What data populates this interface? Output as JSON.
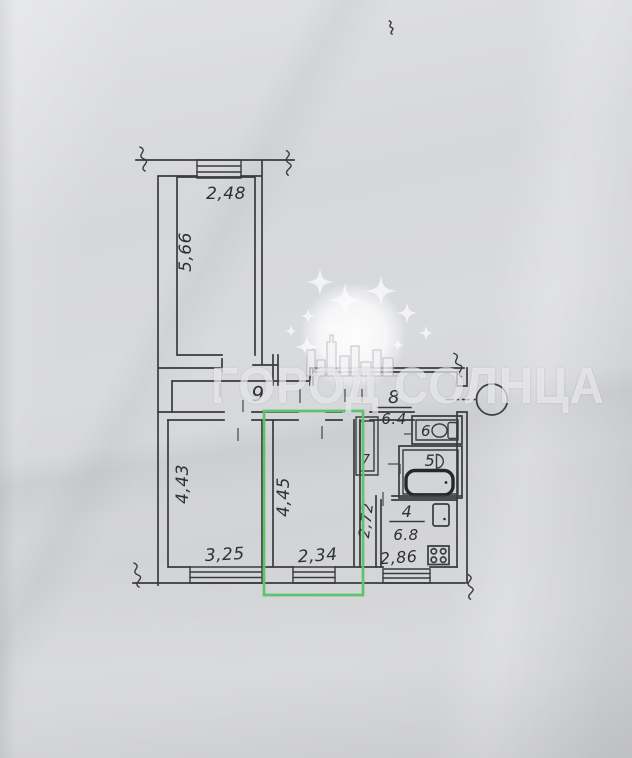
{
  "watermark": {
    "text": "ГОРОД СОЛНЦА"
  },
  "labels": {
    "top_room_width": "2,48",
    "top_room_height": "5,66",
    "corridor_number": "9",
    "hall_number": "8",
    "hall_area": "6.4",
    "closet_number": "7",
    "wc_number": "6",
    "bath_number": "5",
    "kitchen_number": "4",
    "kitchen_area": "6.8",
    "kitchen_width": "2,86",
    "living_height": "4,43",
    "living_width": "3,25",
    "highlight_room_height": "4,45",
    "highlight_room_width": "2,34",
    "hallway_length": "2,72"
  },
  "colors": {
    "highlight_green": "#5ec26f",
    "ink": "#3a3b3f",
    "paper": "#d7d8da"
  }
}
